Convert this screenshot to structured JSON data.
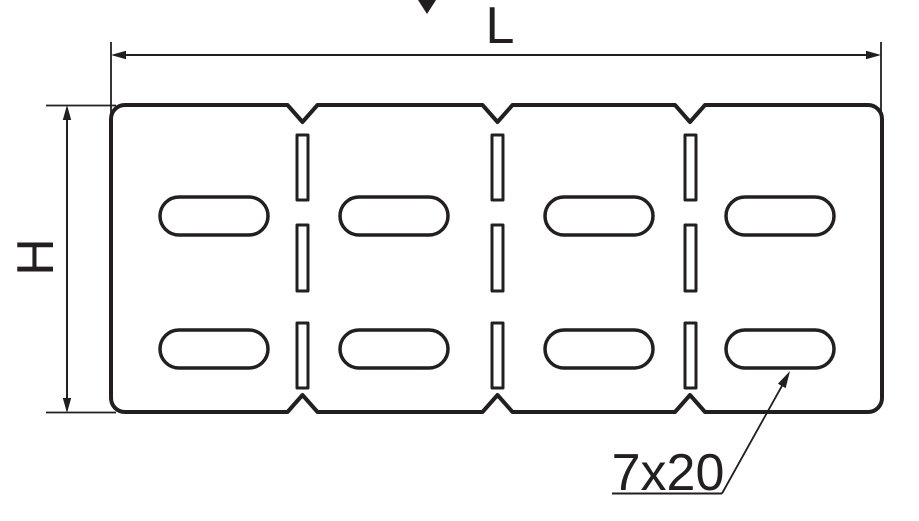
{
  "drawing": {
    "background_color": "#ffffff",
    "line_color": "#231f20",
    "labels": {
      "length_dim": "L",
      "height_dim": "H",
      "slot_size": "7x20"
    },
    "structure": {
      "plate_sections": 4,
      "oblong_slots": 8,
      "divider_slits": 9,
      "top_edge_notches": 3,
      "bottom_edge_notches": 3
    }
  }
}
